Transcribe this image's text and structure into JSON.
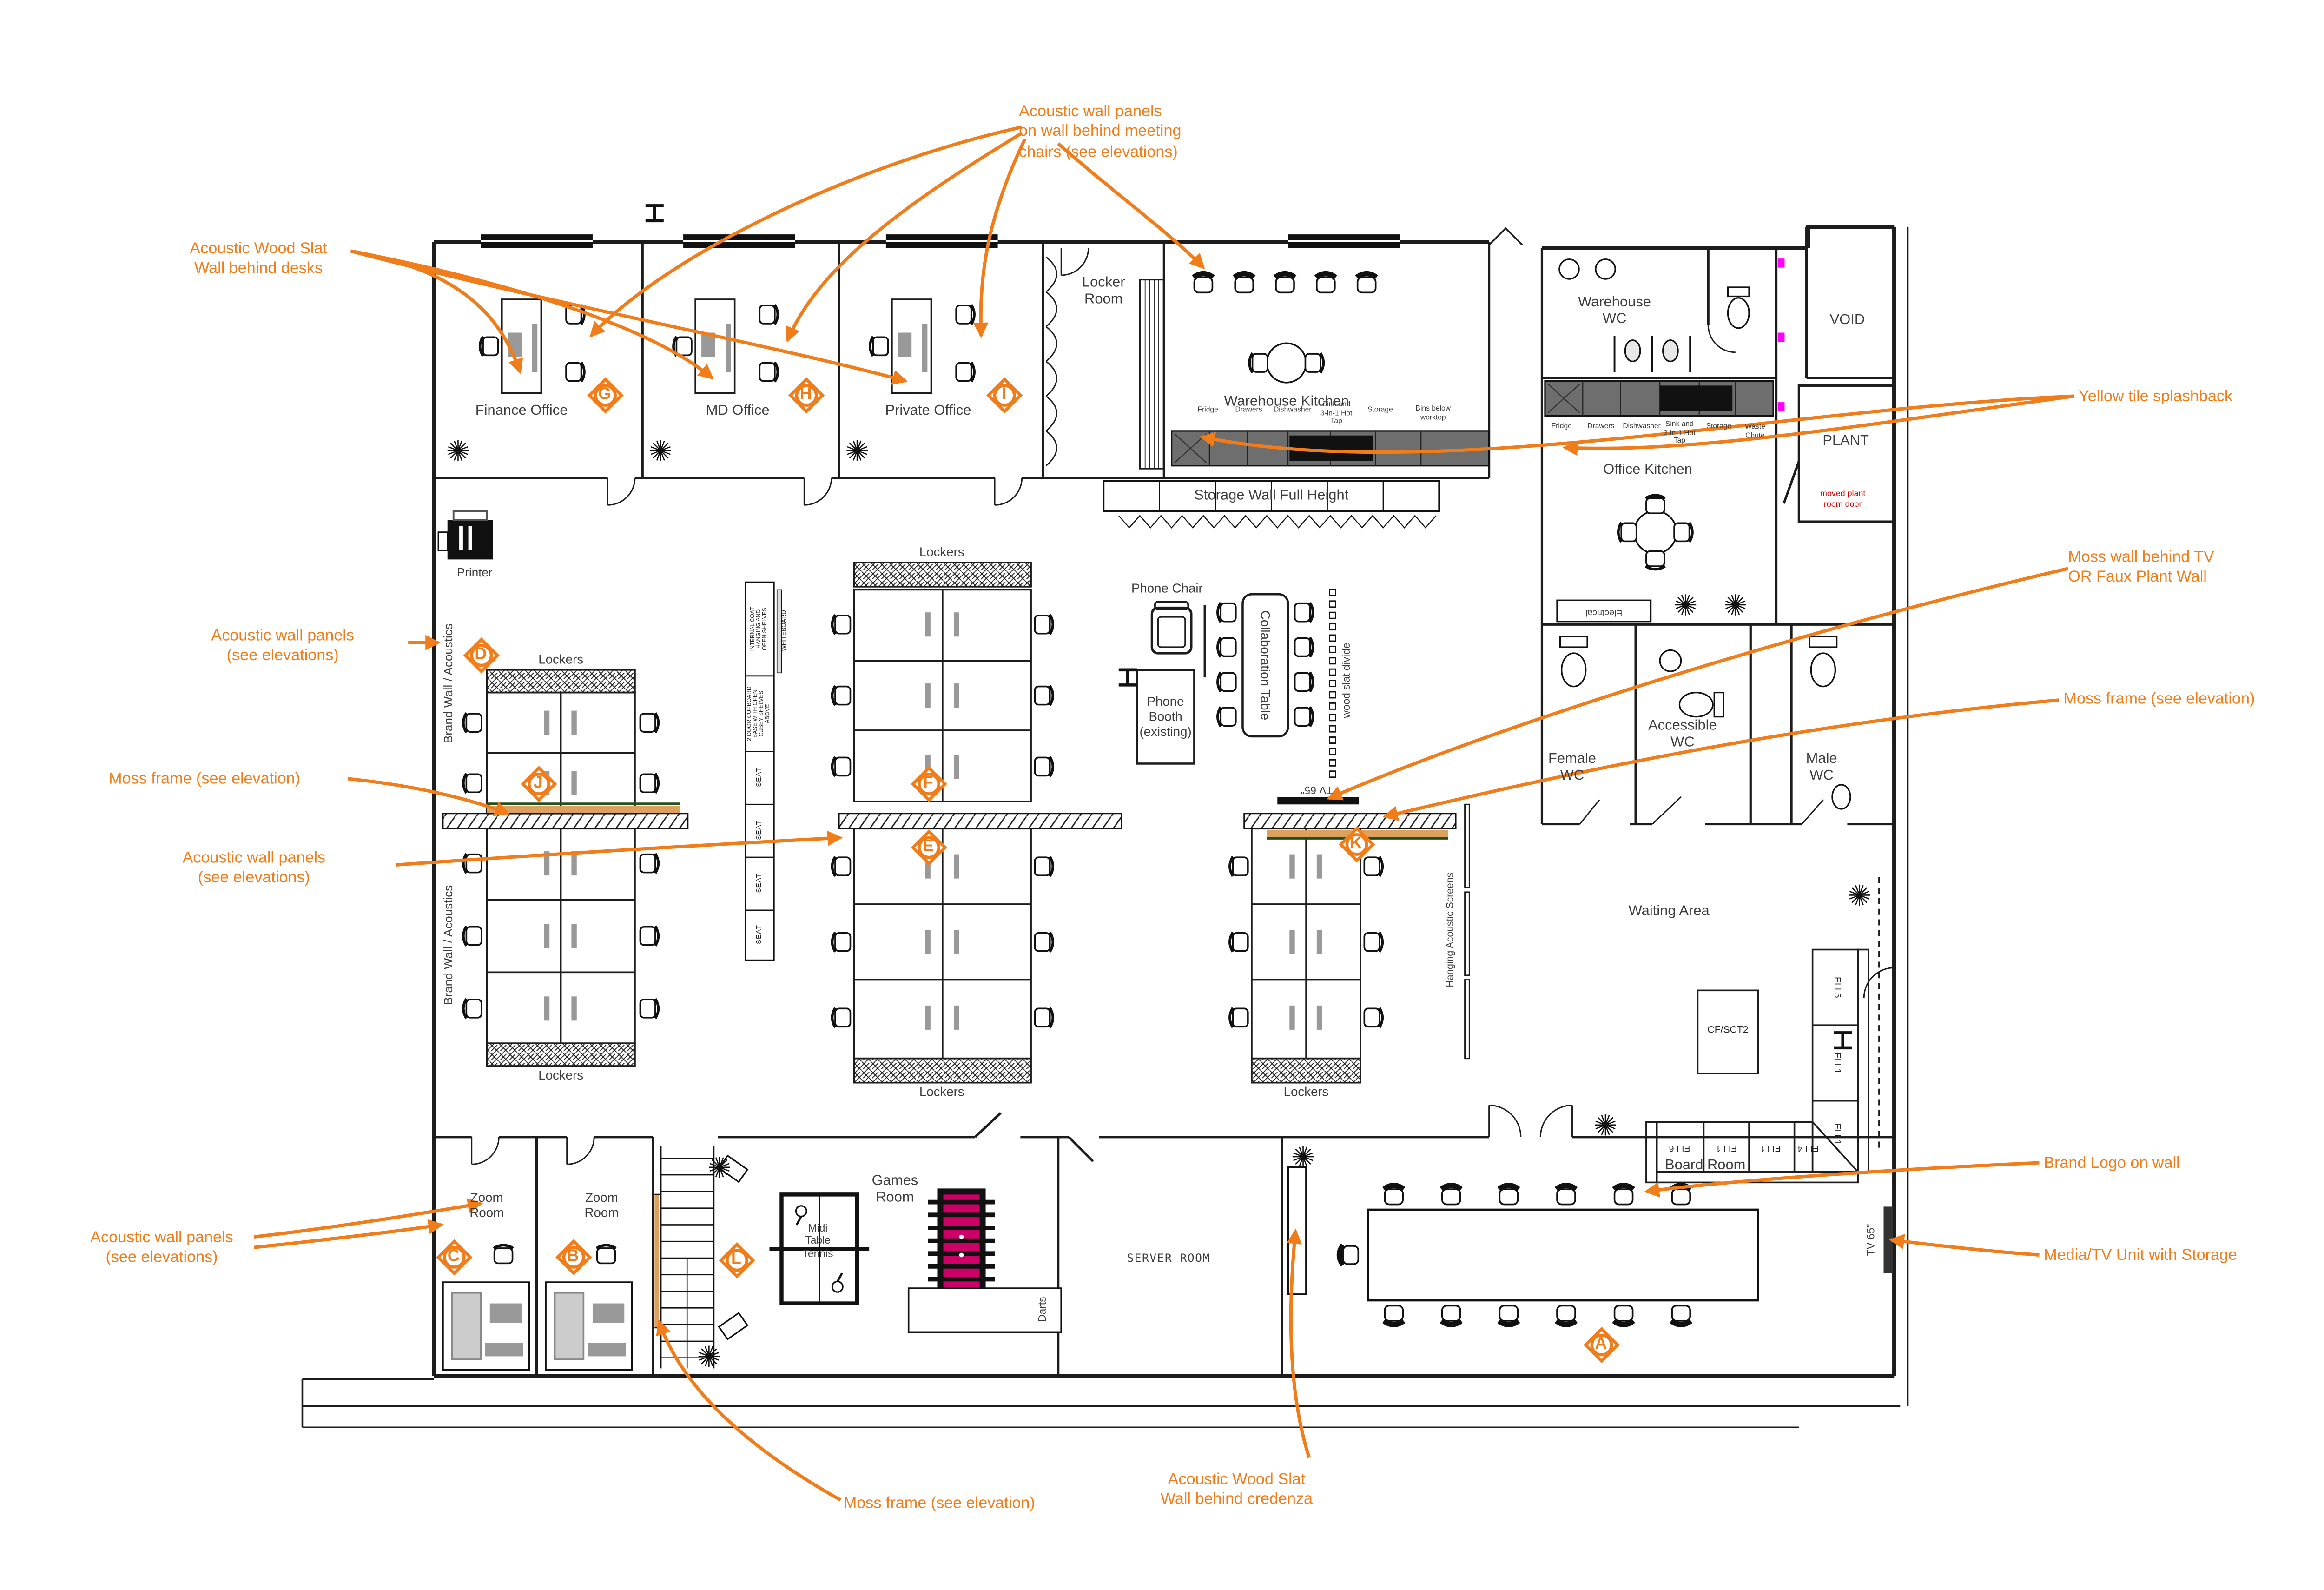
{
  "colors": {
    "annotation": "#F07D1A",
    "wall": "#1c1c1c",
    "counter_gray": "#6e6e6e",
    "furniture_gray": "#999999",
    "moss_tan": "#DDA15E",
    "moss_green": "#234F1E",
    "magenta_dot": "#FF00FF",
    "foosball_pink": "#CC0066",
    "red_note": "#D40000"
  },
  "annotations": {
    "wood_slat_desks": "Acoustic Wood Slat\nWall behind desks",
    "meeting_chairs": "Acoustic wall panels\non wall behind meeting\nchairs (see elevations)",
    "panels": "Acoustic wall panels\n(see elevations)",
    "moss_frame": "Moss frame (see elevation)",
    "yellow_tile": "Yellow tile splashback",
    "moss_wall_tv": "Moss wall behind TV\nOR Faux Plant Wall",
    "brand_logo": "Brand Logo on wall",
    "media_tv": "Media/TV Unit with Storage",
    "wood_slat_credenza": "Acoustic Wood Slat\nWall behind credenza"
  },
  "rooms": {
    "finance_office": "Finance Office",
    "md_office": "MD Office",
    "private_office": "Private Office",
    "locker_room": "Locker\nRoom",
    "warehouse_kitchen": "Warehouse Kitchen",
    "warehouse_wc": "Warehouse\nWC",
    "void": "VOID",
    "plant": "PLANT",
    "moved_plant_note": "moved plant\nroom door",
    "office_kitchen": "Office Kitchen",
    "storage_wall": "Storage Wall Full Height",
    "electrical": "Electrical",
    "female_wc": "Female\nWC",
    "accessible_wc": "Accessible\nWC",
    "male_wc": "Male\nWC",
    "waiting_area": "Waiting Area",
    "board_room": "Board Room",
    "server_room": "SERVER ROOM",
    "games_room": "Games\nRoom",
    "table_tennis": "Midi\nTable\nTennis",
    "darts": "Darts",
    "zoom_room": "Zoom\nRoom",
    "printer": "Printer",
    "phone_chair": "Phone Chair",
    "phone_booth": "Phone\nBooth\n(existing)",
    "collaboration_table": "Collaboration Table",
    "lockers": "Lockers",
    "brand_wall": "Brand Wall / Acoustics",
    "wood_slat_divide": "wood slat divide",
    "hanging_screens": "Hanging Acoustic Screens",
    "tv65": "TV 65\""
  },
  "kitchen_labels": {
    "warehouse": [
      "Fridge",
      "Drawers",
      "Dishwasher",
      "Sink and\n3-in-1 Hot\nTap",
      "Storage",
      "Bins below\nworktop"
    ],
    "office": [
      "Fridge",
      "Drawers",
      "Dishwasher",
      "Sink and\n3-in-1 Hot\nTap",
      "Storage",
      "Waste\nChute"
    ]
  },
  "storage_spine": {
    "top": "INTERNAL COAT\nHANGING AND\nOPEN SHELVES",
    "mid": "2 DOOR CUPBOARD\nBASE WITH OPEN\nCUBBY SHELVES\nABOVE",
    "seat": "SEAT",
    "whiteboard": "WHITEBOARD"
  },
  "sofa": {
    "table": "CF/SCT2",
    "vertical": [
      "ELL5",
      "ELL1",
      "ELL1"
    ],
    "horizontal": [
      "ELL6",
      "ELL1",
      "ELL1",
      "ELL4"
    ]
  },
  "markers": {
    "a": "A",
    "b": "B",
    "c": "C",
    "d": "D",
    "e": "E",
    "f": "F",
    "g": "G",
    "h": "H",
    "i": "I",
    "j": "J",
    "k": "K",
    "l": "L"
  }
}
